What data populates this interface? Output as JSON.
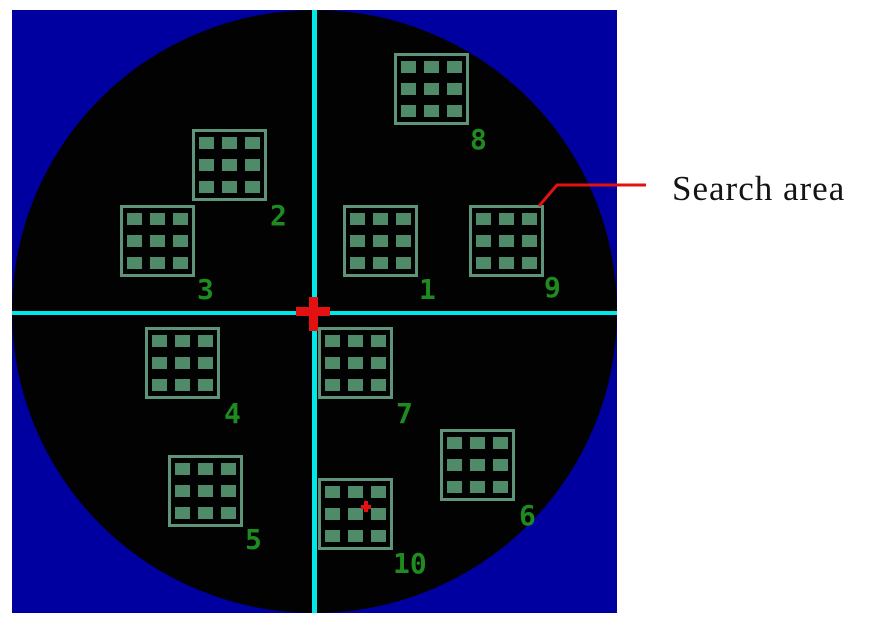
{
  "annotation": {
    "label": "Search area",
    "leader_points": "539,206 557,185 646,185",
    "target_area_id": "9"
  },
  "colors": {
    "background": "#FFFFFF",
    "map_background": "#0000A0",
    "wafer": "#020202",
    "crosshair": "#00E8E8",
    "red": "#E31111",
    "area_border": "#5E947A",
    "area_cell": "#4F8A69",
    "number": "#1F8A1F",
    "annotation_text": "#141414"
  },
  "map": {
    "x": 12,
    "y": 10,
    "width": 605,
    "height": 603
  },
  "crosshair": {
    "vertical_x": 300,
    "horizontal_y": 301
  },
  "search_areas": [
    {
      "id": "1",
      "x": 331,
      "y": 195,
      "label_x": 407,
      "label_y": 268
    },
    {
      "id": "2",
      "x": 180,
      "y": 119,
      "label_x": 258,
      "label_y": 194
    },
    {
      "id": "3",
      "x": 108,
      "y": 195,
      "label_x": 185,
      "label_y": 268
    },
    {
      "id": "4",
      "x": 133,
      "y": 317,
      "label_x": 212,
      "label_y": 392
    },
    {
      "id": "5",
      "x": 156,
      "y": 445,
      "label_x": 233,
      "label_y": 518
    },
    {
      "id": "6",
      "x": 428,
      "y": 419,
      "label_x": 507,
      "label_y": 494
    },
    {
      "id": "7",
      "x": 306,
      "y": 317,
      "label_x": 384,
      "label_y": 392
    },
    {
      "id": "8",
      "x": 382,
      "y": 43,
      "label_x": 458,
      "label_y": 118
    },
    {
      "id": "9",
      "x": 457,
      "y": 195,
      "label_x": 532,
      "label_y": 266
    },
    {
      "id": "10",
      "x": 306,
      "y": 468,
      "label_x": 381,
      "label_y": 542,
      "marker": {
        "x": 349,
        "y": 491
      }
    }
  ]
}
